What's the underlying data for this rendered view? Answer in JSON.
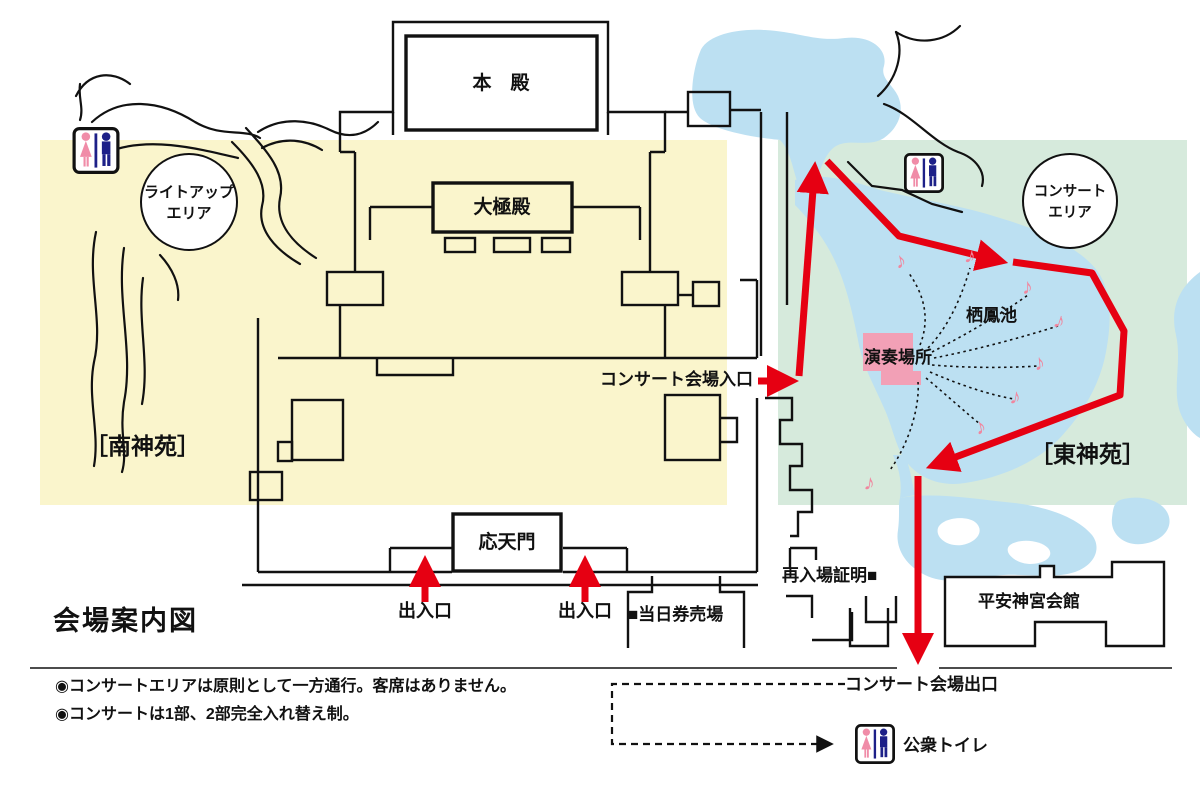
{
  "title": "会場案内図",
  "notes": {
    "line1": "◉コンサートエリアは原則として一方通行。客席はありません。",
    "line2": "◉コンサートは1部、2部完全入れ替え制。"
  },
  "areas": {
    "south_garden": "［南神苑］",
    "east_garden": "［東神苑］",
    "lightup_area_line1": "ライトアップ",
    "lightup_area_line2": "エリア",
    "concert_area_line1": "コンサート",
    "concert_area_line2": "エリア"
  },
  "places": {
    "honden": "本　殿",
    "daigokuden": "大極殿",
    "otenmon": "応天門",
    "seiho_pond": "栖鳳池",
    "stage": "演奏場所",
    "heian_jingu_kaikan": "平安神宮会館"
  },
  "route": {
    "concert_entrance": "コンサート会場入口",
    "concert_exit": "コンサート会場出口",
    "gate_left": "出入口",
    "gate_right": "出入口"
  },
  "facilities": {
    "ticket_office": "■当日券売場",
    "reentry_proof": "再入場証明■",
    "public_toilet": "公衆トイレ"
  },
  "icons": {
    "music_note": "♪"
  },
  "colors": {
    "south_garden_bg": "#FAF5CC",
    "east_garden_bg": "#D6EADC",
    "pond_blue": "#BCE0F2",
    "stage_pink": "#F2A0B6",
    "route_red": "#E60012",
    "toilet_female_pink": "#F08CA8",
    "toilet_male_navy": "#1D2088",
    "line_black": "#111111"
  }
}
